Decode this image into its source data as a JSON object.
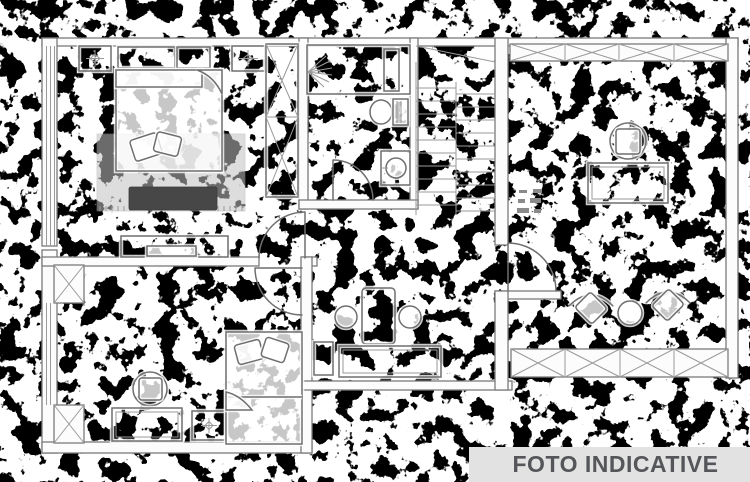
{
  "title": "Apartment floor plan — indicative photo",
  "watermark": {
    "label": "FOTO INDICATIVE"
  },
  "palette": {
    "paper": "#ffffff",
    "noise_ink": "#000000",
    "plan_line": "#6f6f6f",
    "plan_line_soft": "#9a9a9a",
    "wall_fill": "#fcfcfc",
    "carpet_gray": "#c3c3c3",
    "bench_dark": "#474747",
    "banner_bg": "#e2e2e2",
    "banner_fg": "#55565a"
  },
  "rooms": [
    {
      "name": "bedroom-top-left"
    },
    {
      "name": "bathroom-top"
    },
    {
      "name": "staircase"
    },
    {
      "name": "office-top-right"
    },
    {
      "name": "bedroom-bottom-left"
    },
    {
      "name": "bathroom-middle"
    },
    {
      "name": "living-area-bottom-right"
    },
    {
      "name": "corridor"
    }
  ],
  "fixtures": [
    "ceiling-light",
    "double-bed",
    "cushions",
    "carpet",
    "bench",
    "tv-cabinet",
    "wardrobe",
    "shower",
    "toilet",
    "washbasin",
    "stairs",
    "desk",
    "office-chair",
    "armchair",
    "coffee-table",
    "single-bed",
    "desk-chair",
    "vanity-sinks",
    "counter",
    "door",
    "window-band",
    "radiator",
    "dimension-marks"
  ]
}
